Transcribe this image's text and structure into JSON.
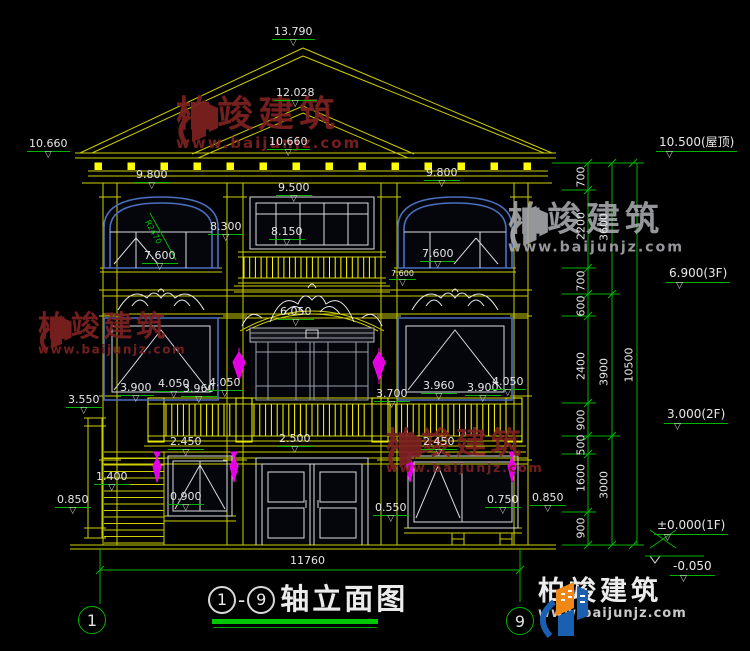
{
  "drawing_title": {
    "axis_start": "1",
    "axis_end": "9",
    "text": "轴立面图"
  },
  "axis_bubbles": {
    "left": "1",
    "right": "9"
  },
  "watermark": {
    "name": "柏竣建筑",
    "url": "www.baijunjz.com"
  },
  "brand": {
    "name": "柏竣建筑",
    "url": "www.baijunjz.com"
  },
  "colors": {
    "line_yellow": "#cfcf00",
    "line_white": "#dcdcdc",
    "line_blue": "#4d6fc0",
    "dim_green": "#00b400",
    "ornament_magenta": "#ff00ff",
    "watermark_red": "#7d2121"
  },
  "labels": [
    {
      "t": "13.790",
      "x": 272,
      "y": 26,
      "cls": "elev"
    },
    {
      "t": "12.028",
      "x": 274,
      "y": 87,
      "cls": "elev"
    },
    {
      "t": "10.660",
      "x": 27,
      "y": 138,
      "cls": "elev"
    },
    {
      "t": "10.660",
      "x": 267,
      "y": 136,
      "cls": "elev"
    },
    {
      "t": "9.800",
      "x": 134,
      "y": 169,
      "cls": "elev"
    },
    {
      "t": "9.800",
      "x": 424,
      "y": 167,
      "cls": "elev"
    },
    {
      "t": "9.500",
      "x": 276,
      "y": 182,
      "cls": "elev"
    },
    {
      "t": "8.300",
      "x": 208,
      "y": 221,
      "cls": "elev"
    },
    {
      "t": "8.150",
      "x": 269,
      "y": 226,
      "cls": "elev"
    },
    {
      "t": "7.600",
      "x": 142,
      "y": 250,
      "cls": "elev"
    },
    {
      "t": "7.600",
      "x": 420,
      "y": 248,
      "cls": "elev"
    },
    {
      "t": "7.600",
      "x": 389,
      "y": 269,
      "cls": "elev sm"
    },
    {
      "t": "6.050",
      "x": 278,
      "y": 306,
      "cls": "elev"
    },
    {
      "t": "3.900",
      "x": 118,
      "y": 382,
      "cls": "elev"
    },
    {
      "t": "4.050",
      "x": 156,
      "y": 378,
      "cls": "elev"
    },
    {
      "t": "3.960",
      "x": 181,
      "y": 383,
      "cls": "elev"
    },
    {
      "t": "4.050",
      "x": 207,
      "y": 377,
      "cls": "elev"
    },
    {
      "t": "3.550",
      "x": 66,
      "y": 394,
      "cls": "elev"
    },
    {
      "t": "3.700",
      "x": 374,
      "y": 388,
      "cls": "elev"
    },
    {
      "t": "3.960",
      "x": 421,
      "y": 380,
      "cls": "elev"
    },
    {
      "t": "3.900",
      "x": 465,
      "y": 382,
      "cls": "elev"
    },
    {
      "t": "4.050",
      "x": 490,
      "y": 376,
      "cls": "elev"
    },
    {
      "t": "2.450",
      "x": 168,
      "y": 436,
      "cls": "elev"
    },
    {
      "t": "2.500",
      "x": 277,
      "y": 433,
      "cls": "elev"
    },
    {
      "t": "2.450",
      "x": 421,
      "y": 436,
      "cls": "elev"
    },
    {
      "t": "1.400",
      "x": 94,
      "y": 471,
      "cls": "elev"
    },
    {
      "t": "0.850",
      "x": 55,
      "y": 494,
      "cls": "elev"
    },
    {
      "t": "0.900",
      "x": 168,
      "y": 491,
      "cls": "elev"
    },
    {
      "t": "0.550",
      "x": 373,
      "y": 502,
      "cls": "elev"
    },
    {
      "t": "0.750",
      "x": 485,
      "y": 494,
      "cls": "elev"
    },
    {
      "t": "0.850",
      "x": 530,
      "y": 492,
      "cls": "elev"
    },
    {
      "t": "11760",
      "x": 290,
      "y": 555,
      "cls": "plain"
    },
    {
      "t": "R2470",
      "x": 152,
      "y": 218,
      "cls": "note"
    }
  ],
  "right_levels": [
    {
      "t": "10.500(屋顶)",
      "x": 656,
      "y": 136
    },
    {
      "t": "6.900(3F)",
      "x": 666,
      "y": 267
    },
    {
      "t": "3.000(2F)",
      "x": 664,
      "y": 408
    },
    {
      "t": "±0.000(1F)",
      "x": 654,
      "y": 519
    },
    {
      "t": "-0.050",
      "x": 670,
      "y": 560
    }
  ],
  "chain_dimensions": [
    {
      "t": "700",
      "x": 581,
      "y": 177
    },
    {
      "t": "2200",
      "x": 581,
      "y": 226
    },
    {
      "t": "3600",
      "x": 604,
      "y": 227
    },
    {
      "t": "700",
      "x": 581,
      "y": 281
    },
    {
      "t": "600",
      "x": 581,
      "y": 306
    },
    {
      "t": "2400",
      "x": 581,
      "y": 366
    },
    {
      "t": "3900",
      "x": 604,
      "y": 372
    },
    {
      "t": "10500",
      "x": 629,
      "y": 365
    },
    {
      "t": "900",
      "x": 581,
      "y": 420
    },
    {
      "t": "500",
      "x": 581,
      "y": 445
    },
    {
      "t": "1600",
      "x": 581,
      "y": 478
    },
    {
      "t": "3000",
      "x": 604,
      "y": 485
    },
    {
      "t": "900",
      "x": 581,
      "y": 528
    }
  ]
}
